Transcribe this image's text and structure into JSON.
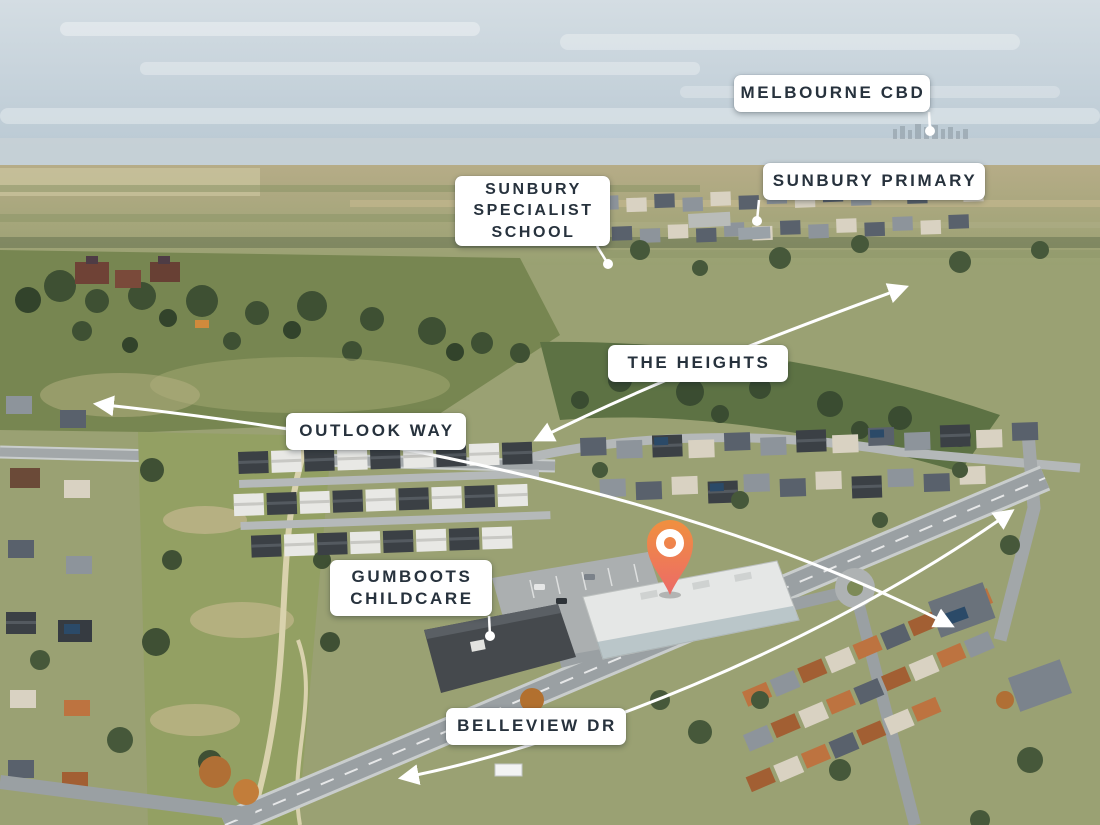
{
  "scene": {
    "description": "Aerial drone photograph of a suburban locality with labelled schools, childcare, streets and an orange site location pin",
    "style": {
      "label_background": "#ffffff",
      "label_text_color": "#27323d",
      "arrow_color": "#ffffff",
      "pin_color_top": "#f0903f",
      "pin_color_bottom": "#ec6a68"
    }
  },
  "annotations": {
    "labels": [
      {
        "id": "melbourne-cbd",
        "text": "MELBOURNE CBD",
        "x": 734,
        "y": 75,
        "w": 196,
        "h": 37,
        "fs": 17
      },
      {
        "id": "sunbury-primary",
        "text": "SUNBURY PRIMARY",
        "x": 763,
        "y": 163,
        "w": 222,
        "h": 37,
        "fs": 17
      },
      {
        "id": "sunbury-specialist-school",
        "text": "SUNBURY\nSPECIALIST\nSCHOOL",
        "x": 455,
        "y": 176,
        "w": 155,
        "h": 70,
        "fs": 16
      },
      {
        "id": "the-heights",
        "text": "THE HEIGHTS",
        "x": 608,
        "y": 345,
        "w": 180,
        "h": 37,
        "fs": 17
      },
      {
        "id": "outlook-way",
        "text": "OUTLOOK WAY",
        "x": 286,
        "y": 413,
        "w": 180,
        "h": 37,
        "fs": 17
      },
      {
        "id": "gumboots-childcare",
        "text": "GUMBOOTS\nCHILDCARE",
        "x": 330,
        "y": 560,
        "w": 162,
        "h": 56,
        "fs": 17
      },
      {
        "id": "belleview-dr",
        "text": "BELLEVIEW DR",
        "x": 446,
        "y": 708,
        "w": 180,
        "h": 37,
        "fs": 17
      }
    ],
    "pointers": [
      {
        "id": "melbourne-cbd",
        "x1": 929,
        "y1": 112,
        "x2": 930,
        "y2": 131
      },
      {
        "id": "sunbury-primary",
        "x1": 759,
        "y1": 200,
        "x2": 757,
        "y2": 221
      },
      {
        "id": "sunbury-specialist-school",
        "x1": 597,
        "y1": 246,
        "x2": 608,
        "y2": 264
      },
      {
        "id": "gumboots-childcare",
        "x1": 489,
        "y1": 616,
        "x2": 490,
        "y2": 636
      }
    ],
    "arrows": [
      {
        "id": "the-heights",
        "path": "M 536 440 C 640 388, 755 342, 906 287"
      },
      {
        "id": "outlook-way",
        "path": "M 96 404 C 360 432, 690 492, 952 626"
      },
      {
        "id": "belleview-dr",
        "path": "M 401 778 C 560 748, 820 648, 1012 511"
      }
    ],
    "pin": {
      "x": 670,
      "y": 595
    }
  }
}
